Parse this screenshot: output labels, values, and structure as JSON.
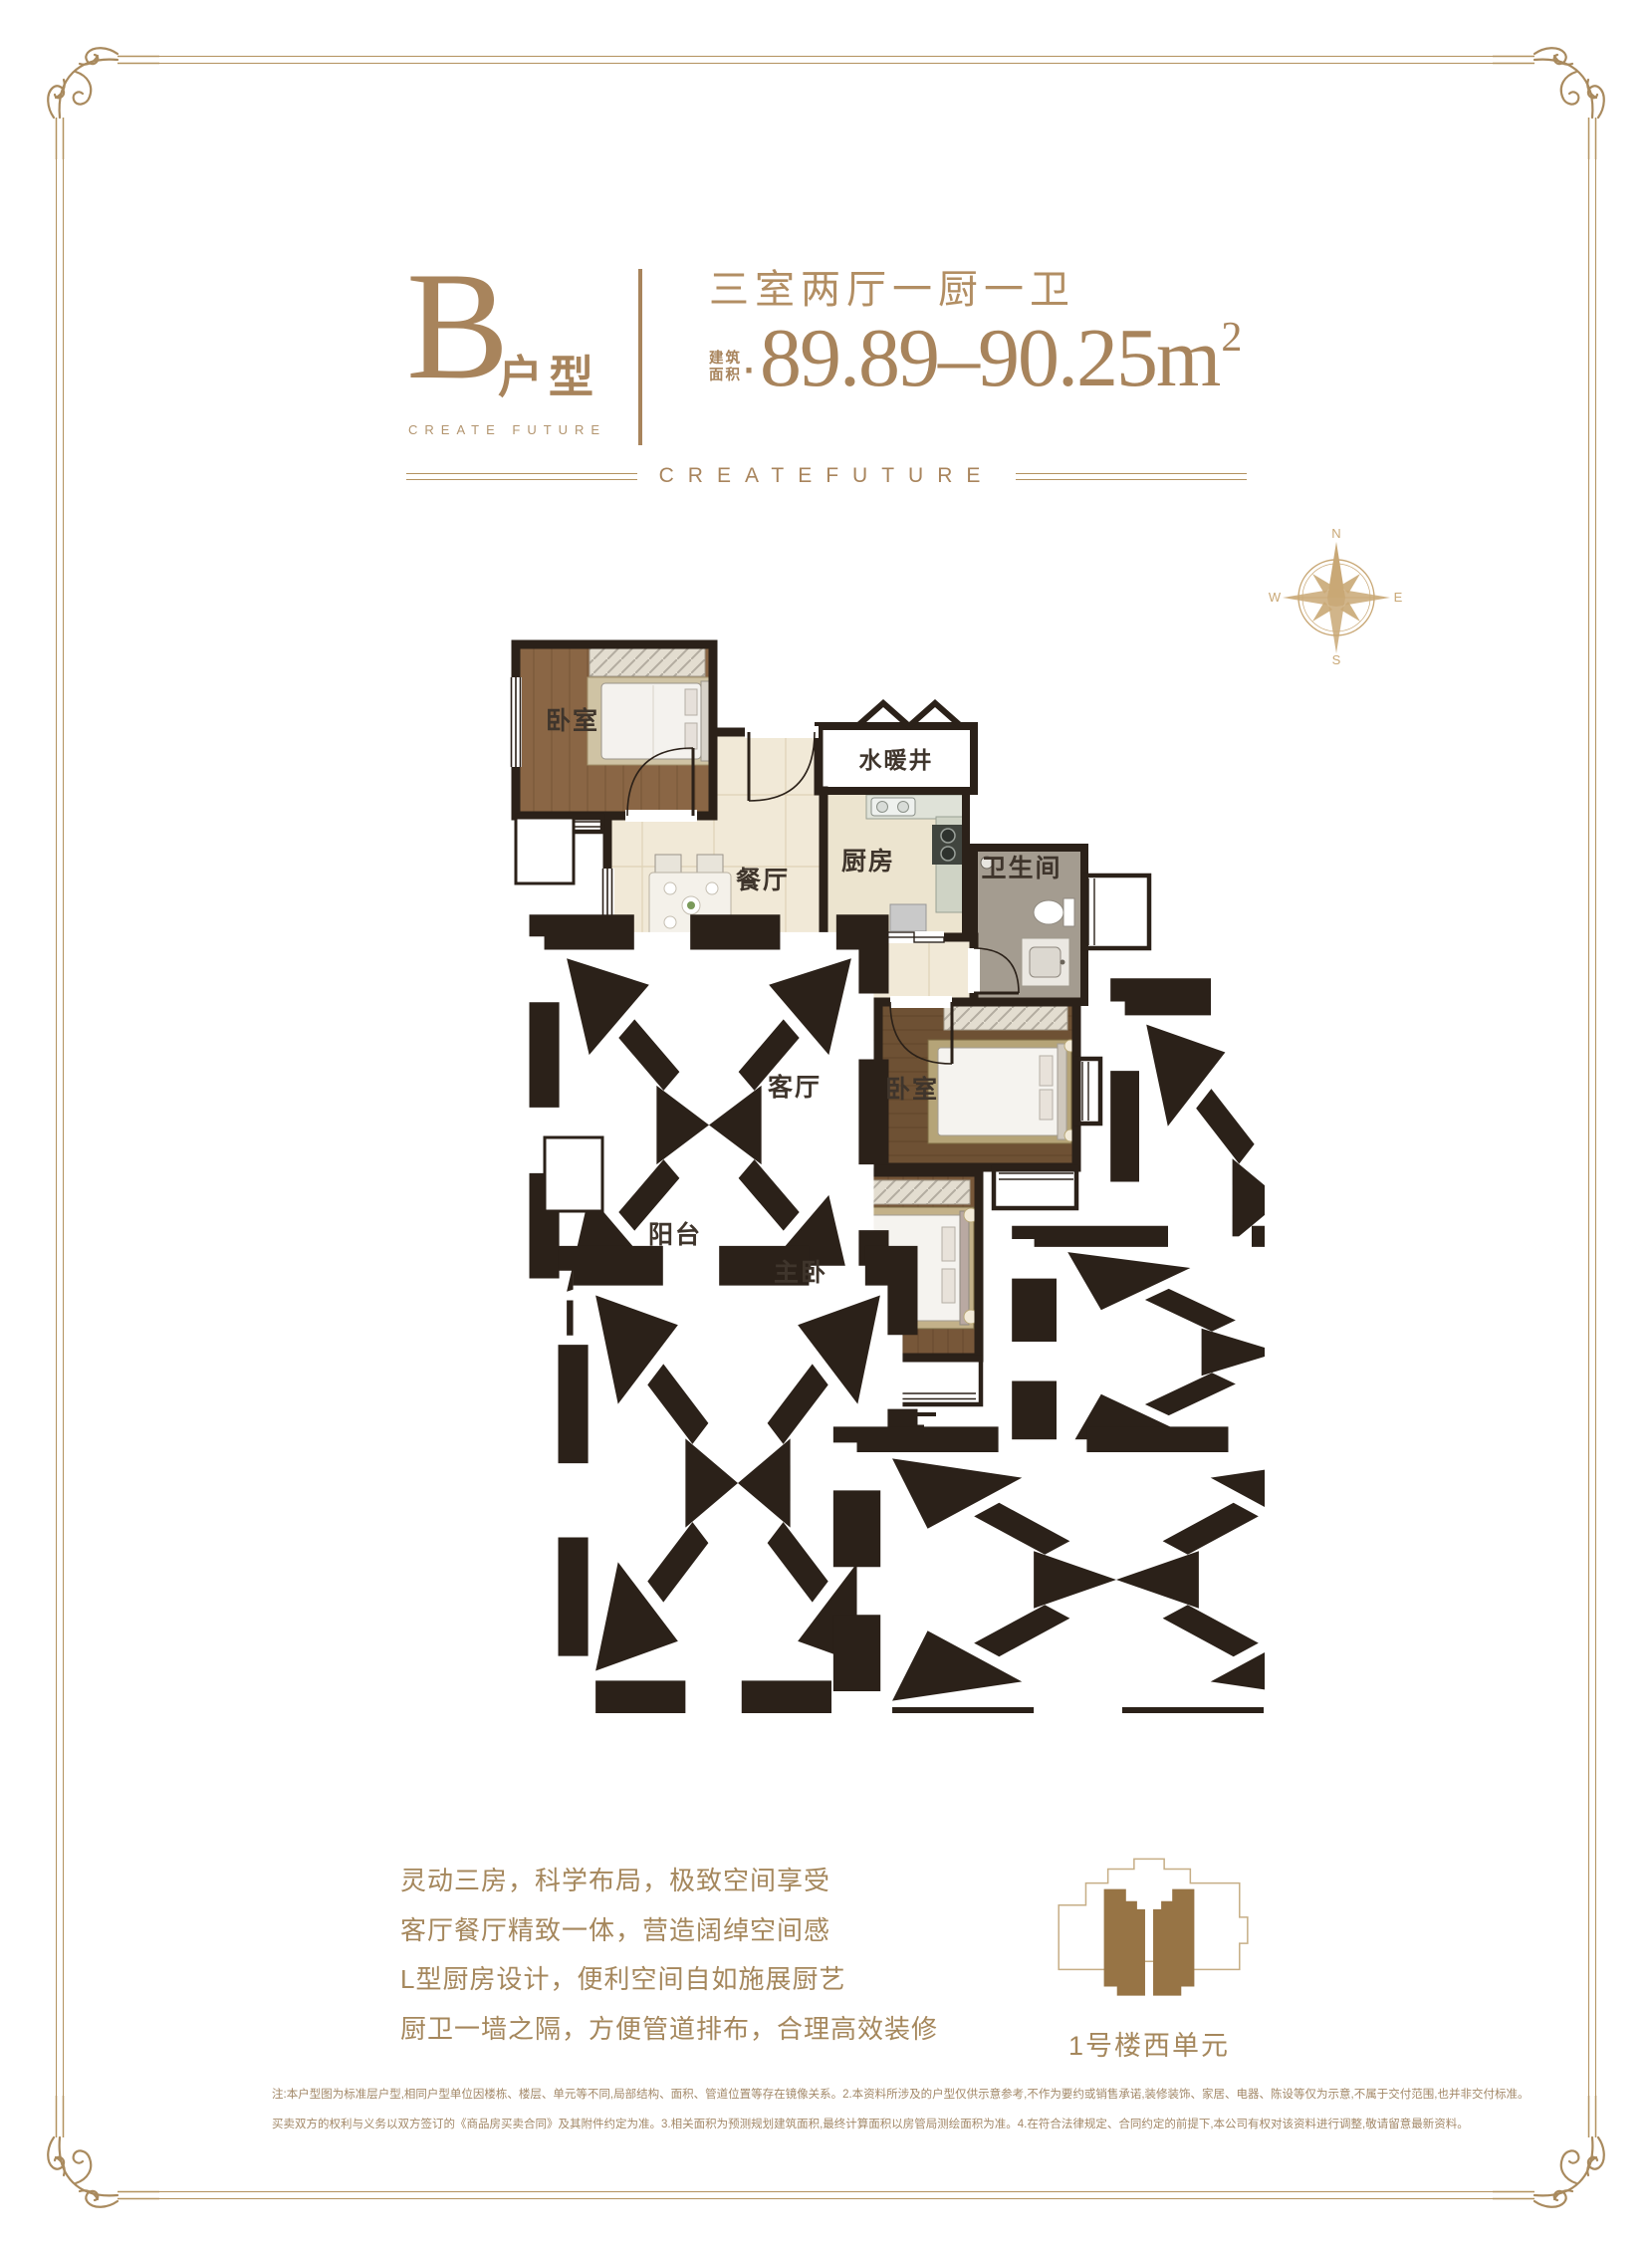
{
  "colors": {
    "accent_gold": "#a8845c",
    "frame_gold": "#b3925f",
    "wall_dark": "#2b2119",
    "text_tan": "#a5875c"
  },
  "header": {
    "type_letter": "B",
    "type_suffix": "户型",
    "tagline": "CREATE FUTURE",
    "rooms_title": "三室两厅一厨一卫",
    "area_label_top": "建筑",
    "area_label_bottom": "面积",
    "area_separator": "·",
    "area_value": "89.89–90.25m",
    "area_superscript": "2"
  },
  "band": {
    "text": "CREATEFUTURE"
  },
  "compass": {
    "north": "N",
    "east": "E",
    "south": "S",
    "west": "W"
  },
  "floorplan": {
    "rooms": [
      {
        "id": "bedroom-top",
        "label": "卧室"
      },
      {
        "id": "utility-shaft",
        "label": "水暖井"
      },
      {
        "id": "dining",
        "label": "餐厅"
      },
      {
        "id": "kitchen",
        "label": "厨房"
      },
      {
        "id": "bathroom",
        "label": "卫生间"
      },
      {
        "id": "living",
        "label": "客厅"
      },
      {
        "id": "bedroom-right",
        "label": "卧室"
      },
      {
        "id": "balcony",
        "label": "阳台"
      },
      {
        "id": "master-bedroom",
        "label": "主卧"
      }
    ]
  },
  "features": {
    "lines": [
      "灵动三房，科学布局，极致空间享受",
      "客厅餐厅精致一体，营造阔绰空间感",
      "L型厨房设计，便利空间自如施展厨艺",
      "厨卫一墙之隔，方便管道排布，合理高效装修"
    ]
  },
  "location_key": {
    "label": "1号楼西单元"
  },
  "disclaimer": {
    "line1": "注:本户型图为标准层户型,相同户型单位因楼栋、楼层、单元等不同,局部结构、面积、管道位置等存在镜像关系。2.本资料所涉及的户型仅供示意参考,不作为要约或销售承诺,装修装饰、家居、电器、陈设等仅为示意,不属于交付范围,也并非交付标准。",
    "line2": "买卖双方的权利与义务以双方签订的《商品房买卖合同》及其附件约定为准。3.相关面积为预测规划建筑面积,最终计算面积以房管局测绘面积为准。4.在符合法律规定、合同约定的前提下,本公司有权对该资料进行调整,敬请留意最新资料。"
  }
}
